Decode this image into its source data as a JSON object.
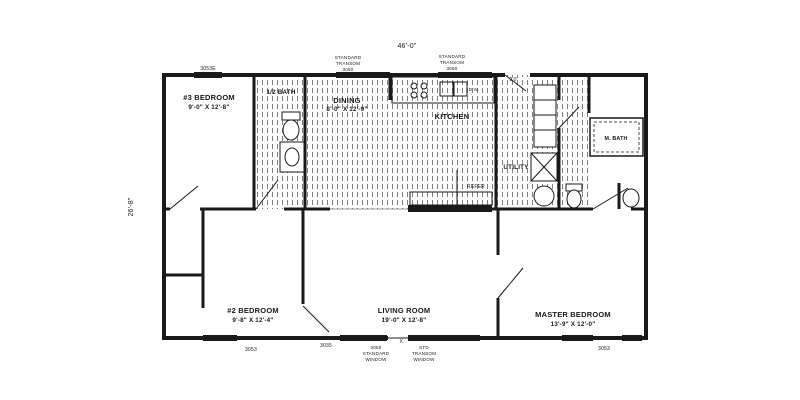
{
  "colors": {
    "ink": "#1a1a1a",
    "paper": "#ffffff"
  },
  "dimensions": {
    "width": "46'-0\"",
    "depth": "26'-8\""
  },
  "rooms": {
    "bedroom3": {
      "name": "#3 BEDROOM",
      "size": "9'-0\" X 12'-8\""
    },
    "half_bath": {
      "name": "1/2 BATH"
    },
    "dining": {
      "name": "DINING",
      "size": "8'-0\" X 12'-9\""
    },
    "kitchen": {
      "name": "KITCHEN"
    },
    "utility": {
      "name": "UTILITY"
    },
    "master_bath": {
      "name": "M. BATH"
    },
    "bedroom2": {
      "name": "#2 BEDROOM",
      "size": "9'-8\" X 12'-4\""
    },
    "living_room": {
      "name": "LIVING ROOM",
      "size": "19'-0\" X 12'-8\""
    },
    "master_bedroom": {
      "name": "MASTER BEDROOM",
      "size": "13'-9\" X 12'-0\""
    }
  },
  "appliances": {
    "refrigerator": "REFER",
    "dishwasher": "D.W."
  },
  "openings": {
    "window_top_left": "3053E",
    "transom_top": [
      "STANDARD",
      "TRANSOM",
      "3050"
    ],
    "rear_door": "3'0\"",
    "window_bottom_left": "3053",
    "door_bedroom2": "3035",
    "marriage_mark": "X.",
    "std_window": [
      "3050",
      "STANDARD",
      "WINDOW"
    ],
    "std_transom": [
      "STD",
      "TRANSOM",
      "WINDOW"
    ],
    "window_bottom_right": "3053"
  }
}
